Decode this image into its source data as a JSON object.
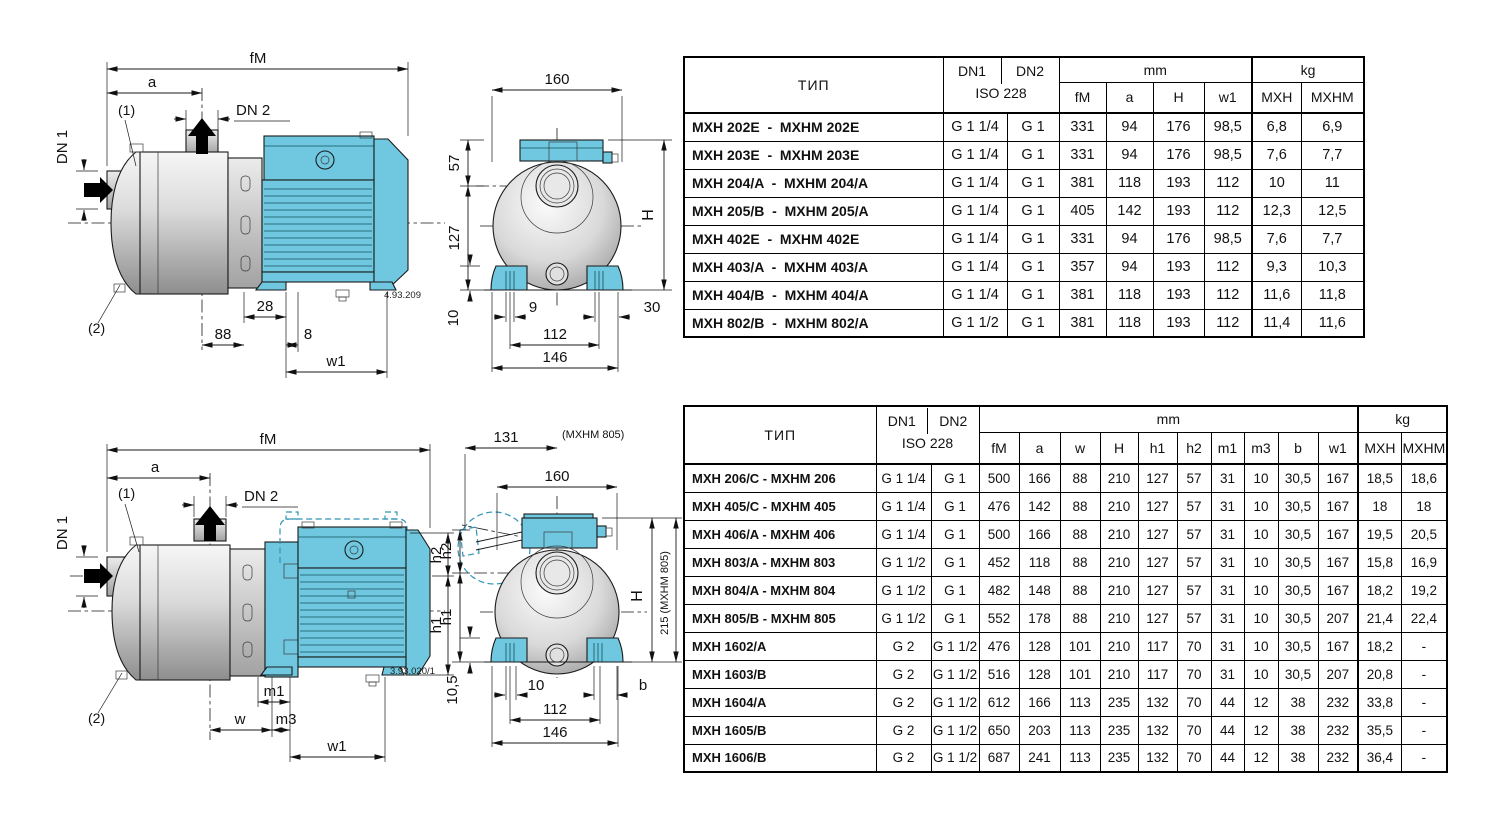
{
  "colors": {
    "motor_blue": "#6fc8e0",
    "motor_blue_dark": "#2e93b5",
    "outline_black": "#1a1a1a",
    "pump_gray": "#d9d9d9"
  },
  "drawing_top_side": {
    "dim_fm": "fM",
    "dim_a": "a",
    "dn2": "DN 2",
    "dn1": "DN 1",
    "callout_1": "(1)",
    "callout_2": "(2)",
    "dim_28": "28",
    "dim_88": "88",
    "dim_8": "8",
    "dim_w1": "w1",
    "ref": "4.93.209"
  },
  "drawing_top_front": {
    "dim_160": "160",
    "dim_57": "57",
    "dim_127": "127",
    "dim_h": "H",
    "dim_9": "9",
    "dim_30": "30",
    "dim_112": "112",
    "dim_146": "146",
    "dim_10": "10"
  },
  "drawing_bottom_side": {
    "dim_fm": "fM",
    "dim_a": "a",
    "dn2": "DN 2",
    "dn1": "DN 1",
    "callout_1": "(1)",
    "callout_2": "(2)",
    "dim_m1": "m1",
    "dim_w": "w",
    "dim_m3": "m3",
    "dim_w1": "w1",
    "dim_h2": "h2",
    "dim_h1": "h1",
    "ref": "3.93.020/1"
  },
  "drawing_bottom_front": {
    "dim_131": "131",
    "note_mxhm805": "(MXHM 805)",
    "dim_160": "160",
    "dim_h2": "h2",
    "dim_h1": "h1",
    "dim_h": "H",
    "dim_215": "215 (MXHM 805)",
    "dim_105": "10,5",
    "dim_10": "10",
    "dim_b": "b",
    "dim_112": "112",
    "dim_146": "146"
  },
  "table1": {
    "header": {
      "tip": "ТИП",
      "dn1": "DN1",
      "dn2": "DN2",
      "iso": "ISO 228",
      "mm": "mm",
      "kg": "kg",
      "mm_cols": [
        "fM",
        "a",
        "H",
        "w1"
      ],
      "kg_cols": [
        "MXH",
        "MXHM"
      ]
    },
    "rows": [
      [
        "MXH 202E  -  MXHM 202E",
        "G 1 1/4",
        "G 1",
        "331",
        "94",
        "176",
        "98,5",
        "6,8",
        "6,9"
      ],
      [
        "MXH 203E  -  MXHM 203E",
        "G 1 1/4",
        "G 1",
        "331",
        "94",
        "176",
        "98,5",
        "7,6",
        "7,7"
      ],
      [
        "MXH 204/A  -  MXHM 204/A",
        "G 1 1/4",
        "G 1",
        "381",
        "118",
        "193",
        "112",
        "10",
        "11"
      ],
      [
        "MXH 205/B  -  MXHM 205/A",
        "G 1 1/4",
        "G 1",
        "405",
        "142",
        "193",
        "112",
        "12,3",
        "12,5"
      ],
      [
        "MXH 402E  -  MXHM 402E",
        "G 1 1/4",
        "G 1",
        "331",
        "94",
        "176",
        "98,5",
        "7,6",
        "7,7"
      ],
      [
        "MXH 403/A  -  MXHM 403/A",
        "G 1 1/4",
        "G 1",
        "357",
        "94",
        "193",
        "112",
        "9,3",
        "10,3"
      ],
      [
        "MXH 404/B  -  MXHM 404/A",
        "G 1 1/4",
        "G 1",
        "381",
        "118",
        "193",
        "112",
        "11,6",
        "11,8"
      ],
      [
        "MXH 802/B  -  MXHM 802/A",
        "G 1 1/2",
        "G 1",
        "381",
        "118",
        "193",
        "112",
        "11,4",
        "11,6"
      ]
    ]
  },
  "table2": {
    "header": {
      "tip": "ТИП",
      "dn1": "DN1",
      "dn2": "DN2",
      "iso": "ISO 228",
      "mm": "mm",
      "kg": "kg",
      "mm_cols": [
        "fM",
        "a",
        "w",
        "H",
        "h1",
        "h2",
        "m1",
        "m3",
        "b",
        "w1"
      ],
      "kg_cols": [
        "MXH",
        "MXHM"
      ]
    },
    "rows": [
      [
        "MXH 206/C - MXHM 206",
        "G 1 1/4",
        "G 1",
        "500",
        "166",
        "88",
        "210",
        "127",
        "57",
        "31",
        "10",
        "30,5",
        "167",
        "18,5",
        "18,6"
      ],
      [
        "MXH 405/C - MXHM 405",
        "G 1 1/4",
        "G 1",
        "476",
        "142",
        "88",
        "210",
        "127",
        "57",
        "31",
        "10",
        "30,5",
        "167",
        "18",
        "18"
      ],
      [
        "MXH 406/A - MXHM 406",
        "G 1 1/4",
        "G 1",
        "500",
        "166",
        "88",
        "210",
        "127",
        "57",
        "31",
        "10",
        "30,5",
        "167",
        "19,5",
        "20,5"
      ],
      [
        "MXH 803/A - MXHM 803",
        "G 1 1/2",
        "G 1",
        "452",
        "118",
        "88",
        "210",
        "127",
        "57",
        "31",
        "10",
        "30,5",
        "167",
        "15,8",
        "16,9"
      ],
      [
        "MXH 804/A - MXHM 804",
        "G 1 1/2",
        "G 1",
        "482",
        "148",
        "88",
        "210",
        "127",
        "57",
        "31",
        "10",
        "30,5",
        "167",
        "18,2",
        "19,2"
      ],
      [
        "MXH 805/B - MXHM 805",
        "G 1 1/2",
        "G 1",
        "552",
        "178",
        "88",
        "210",
        "127",
        "57",
        "31",
        "10",
        "30,5",
        "207",
        "21,4",
        "22,4"
      ],
      [
        "MXH 1602/A",
        "G 2",
        "G 1 1/2",
        "476",
        "128",
        "101",
        "210",
        "117",
        "70",
        "31",
        "10",
        "30,5",
        "167",
        "18,2",
        "-"
      ],
      [
        "MXH 1603/B",
        "G 2",
        "G 1 1/2",
        "516",
        "128",
        "101",
        "210",
        "117",
        "70",
        "31",
        "10",
        "30,5",
        "207",
        "20,8",
        "-"
      ],
      [
        "MXH 1604/A",
        "G 2",
        "G 1 1/2",
        "612",
        "166",
        "113",
        "235",
        "132",
        "70",
        "44",
        "12",
        "38",
        "232",
        "33,8",
        "-"
      ],
      [
        "MXH 1605/B",
        "G 2",
        "G 1 1/2",
        "650",
        "203",
        "113",
        "235",
        "132",
        "70",
        "44",
        "12",
        "38",
        "232",
        "35,5",
        "-"
      ],
      [
        "MXH 1606/B",
        "G 2",
        "G 1 1/2",
        "687",
        "241",
        "113",
        "235",
        "132",
        "70",
        "44",
        "12",
        "38",
        "232",
        "36,4",
        "-"
      ]
    ]
  }
}
